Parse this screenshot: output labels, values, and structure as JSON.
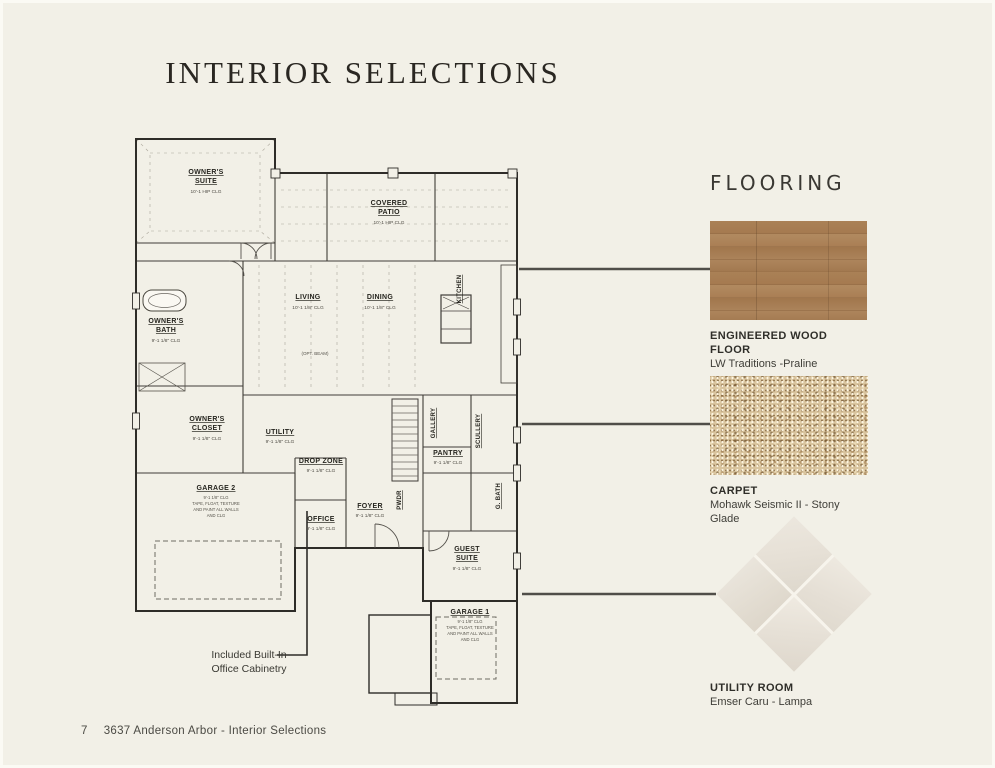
{
  "page": {
    "title": "INTERIOR SELECTIONS",
    "footer": {
      "page_number": "7",
      "text": "3637 Anderson Arbor  - Interior Selections"
    },
    "background_color": "#f2f0e7"
  },
  "flooring": {
    "heading": "FLOORING",
    "items": [
      {
        "id": "engineered-wood",
        "name": "ENGINEERED WOOD FLOOR",
        "product": "LW Traditions -Praline",
        "swatch": "wood-planks",
        "color": "#a47a51"
      },
      {
        "id": "carpet",
        "name": "CARPET",
        "product": "Mohawk Seismic II - Stony Glade",
        "swatch": "carpet-speckle",
        "color": "#d9c49e"
      },
      {
        "id": "utility-tile",
        "name": "UTILITY ROOM",
        "product": "Emser Caru - Lampa",
        "swatch": "tile-diamond",
        "color": "#e9e4db"
      }
    ]
  },
  "floor_plan": {
    "annotation": {
      "lines": [
        "Included Built-In",
        "Office Cabinetry"
      ]
    },
    "opt_beam_label": "(OPT. BEAM)",
    "rooms": {
      "owners_suite": {
        "lines": [
          "OWNER'S",
          "SUITE"
        ],
        "clg": "10'-1 HIP CLG"
      },
      "covered_patio": {
        "lines": [
          "COVERED",
          "PATIO"
        ],
        "clg": "10'-1 HIP CLG"
      },
      "living": {
        "lines": [
          "LIVING"
        ],
        "clg": "10'-1 1/8\" CLG"
      },
      "dining": {
        "lines": [
          "DINING"
        ],
        "clg": "10'-1 1/8\" CLG"
      },
      "kitchen": {
        "lines": [
          "KITCHEN"
        ]
      },
      "owners_bath": {
        "lines": [
          "OWNER'S",
          "BATH"
        ],
        "clg": "9'-1 1/8\" CLG"
      },
      "owners_closet": {
        "lines": [
          "OWNER'S",
          "CLOSET"
        ],
        "clg": "9'-1 1/8\" CLG"
      },
      "utility": {
        "lines": [
          "UTILITY"
        ],
        "clg": "9'-1 1/8\" CLG"
      },
      "drop_zone": {
        "lines": [
          "DROP ZONE"
        ],
        "clg": "9'-1 1/8\" CLG"
      },
      "office": {
        "lines": [
          "OFFICE"
        ],
        "clg": "9'-1 1/8\" CLG"
      },
      "foyer": {
        "lines": [
          "FOYER"
        ],
        "clg": "9'-1 1/8\" CLG"
      },
      "pwdr": {
        "lines": [
          "PWDR"
        ]
      },
      "gallery": {
        "lines": [
          "GALLERY"
        ]
      },
      "pantry": {
        "lines": [
          "PANTRY"
        ],
        "clg": "9'-1 1/8\" CLG"
      },
      "scullery": {
        "lines": [
          "SCULLERY"
        ]
      },
      "guest_bath": {
        "lines": [
          "G. BATH"
        ]
      },
      "guest_suite": {
        "lines": [
          "GUEST",
          "SUITE"
        ],
        "clg": "9'-1 1/8\" CLG"
      },
      "garage_2": {
        "lines": [
          "GARAGE 2"
        ],
        "notes": [
          "9'-1 1/8\" CLG",
          "TAPE, FLOAT, TEXTURE",
          "AND PAINT ALL WALLS",
          "AND CLG"
        ]
      },
      "garage_1": {
        "lines": [
          "GARAGE 1"
        ],
        "notes": [
          "9'-1 1/8\" CLG",
          "TAPE, FLOAT, TEXTURE",
          "AND PAINT ALL WALLS",
          "AND CLG"
        ]
      }
    }
  }
}
